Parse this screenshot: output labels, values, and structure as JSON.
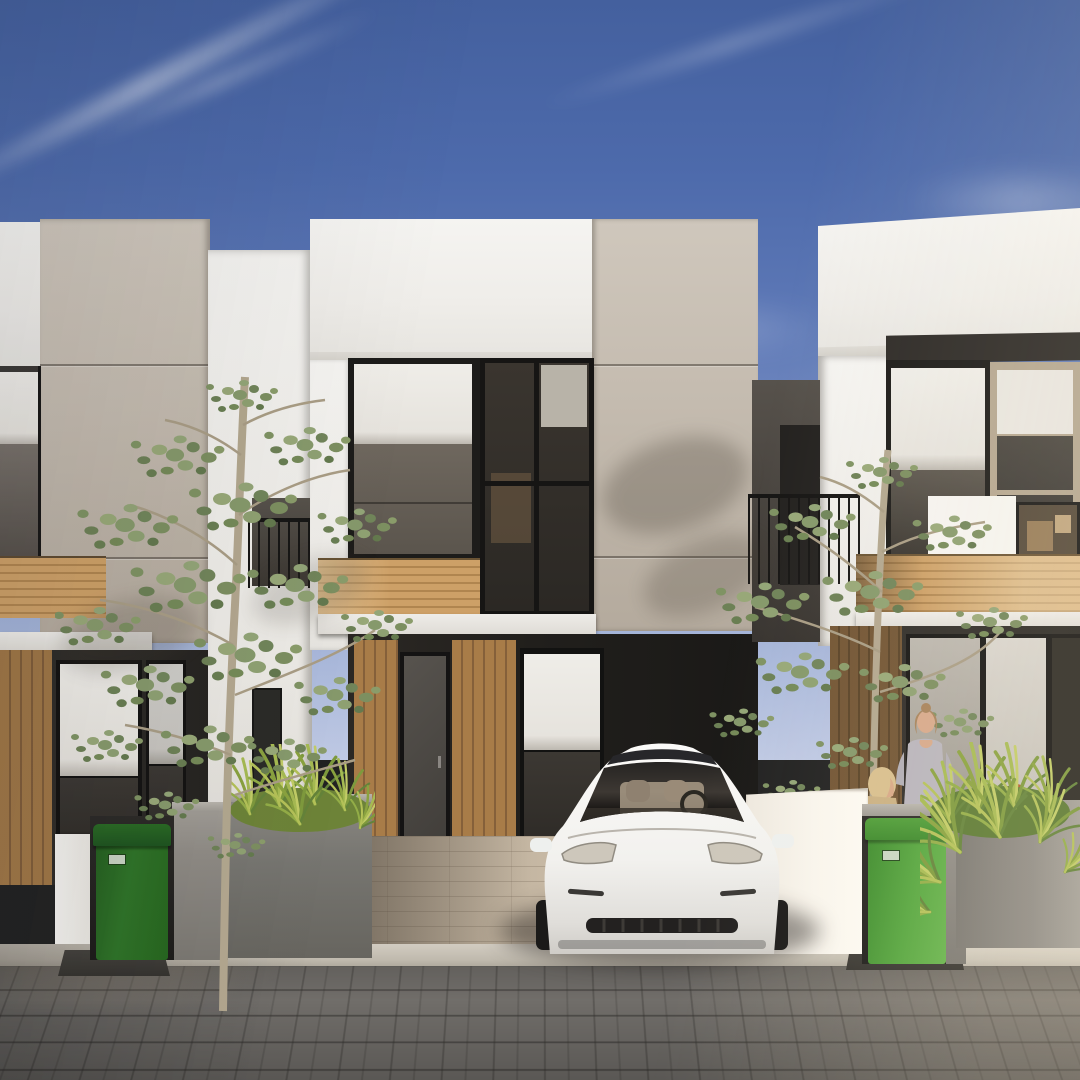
{
  "scene": {
    "title": "Modern minimalist townhouse row — exterior 3D rendering",
    "description": "Daytime architectural rendering of a row of three modern two-storey townhouses in white and taupe with black-framed glazing and light oak slat accents. A white electric sedan is parked in the centre carport. Two slender green trees stand in front, concrete planter walls with ornamental grass line the street, a green wheelie bin sits at each property, and three figures (two women and a red-haired child) occupy the right front terrace. Grey block-paved street in the foreground under a clear blue sky with wispy clouds.",
    "sky": "clear blue, wispy diagonal cirrus clouds, sun low from the right",
    "ground": "grey running-bond paver street, light stone curb, tan paver driveway"
  },
  "palette": {
    "sky_top": "#44609e",
    "sky_horizon": "#bfc9e4",
    "cloud": "#ffffff",
    "wall_white": "#f5f4f1",
    "wall_beige": "#c4bbaf",
    "wood_slats": "#b0854f",
    "frame_dark": "#1d1c1a",
    "glass": "#37332e",
    "roller_shade": "#eceae5",
    "concrete_wall": "#8f8b85",
    "planter_grass": "#9cb14f",
    "bin_green_lit": "#55a63e",
    "bin_green_shade": "#2f7328",
    "street_paver": "#716e6a",
    "driveway_paver": "#c3b5a1",
    "car_body": "#f6f5f2",
    "car_glass": "#2c2a28",
    "tree_foliage": "#86996b",
    "tree_trunk": "#b3a78f"
  },
  "objects": {
    "houses": [
      {
        "id": "left-house",
        "label": "left townhouse, partially cropped",
        "features": "beige upper volume, dark corner window, oak slat band, dark ground floor with roller-shade windows"
      },
      {
        "id": "center-house",
        "label": "centre townhouse",
        "features": "white parapet, large black-framed upper window with half-drawn white roller shade, taupe pier, oak slat band, carport with entry door"
      },
      {
        "id": "right-house",
        "label": "right townhouse",
        "features": "white volume, tan-framed glazing, balcony with black railing, sunlit oak band, front terrace"
      }
    ],
    "vehicle": {
      "id": "white-sedan",
      "label": "white electric sedan parked nose-out in centre carport",
      "color": "#f6f5f2"
    },
    "trees": [
      {
        "id": "left-tree",
        "label": "slender young tree in front of centre-left facade"
      },
      {
        "id": "right-tree",
        "label": "slender young tree in front of right facade"
      }
    ],
    "bins": [
      {
        "id": "left-bin",
        "label": "green wheelie bin in shaded niche, left property"
      },
      {
        "id": "right-bin",
        "label": "sunlit green wheelie bin, right property"
      }
    ],
    "people": [
      {
        "id": "woman-standing",
        "label": "woman in grey top standing on right terrace"
      },
      {
        "id": "woman-blonde",
        "label": "blonde woman partly hidden behind wall"
      },
      {
        "id": "child-redhead",
        "label": "red-haired child crouching behind grass"
      }
    ],
    "planters": [
      {
        "id": "left-planter",
        "label": "concrete planter wall with ornamental grass, left"
      },
      {
        "id": "right-planter",
        "label": "concrete planter wall with ornamental grass, right"
      }
    ]
  }
}
